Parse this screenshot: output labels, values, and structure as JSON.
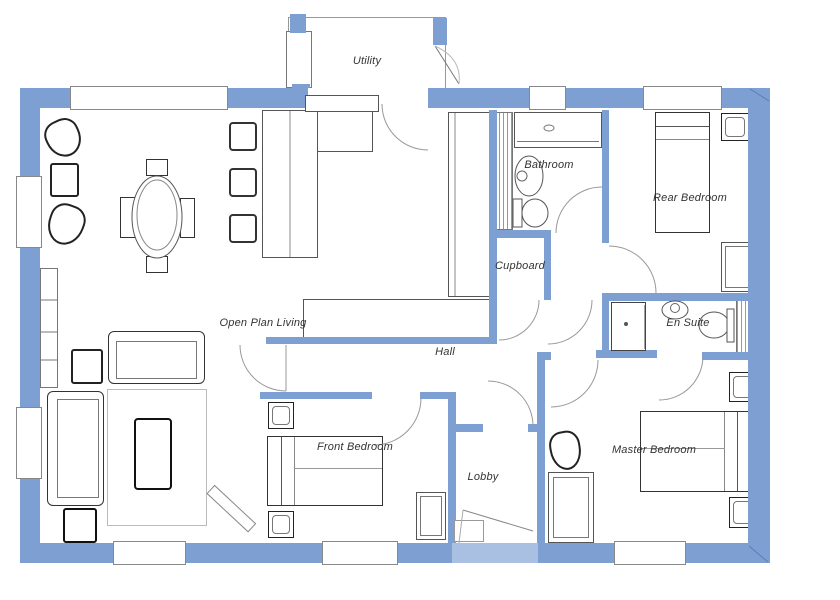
{
  "floorplan": {
    "rooms": {
      "utility": {
        "label": "Utility"
      },
      "bathroom": {
        "label": "Bathroom"
      },
      "rear_bedroom": {
        "label": "Rear Bedroom"
      },
      "cupboard": {
        "label": "Cupboard"
      },
      "open_plan_living": {
        "label": "Open Plan Living"
      },
      "en_suite": {
        "label": "En Suite"
      },
      "hall": {
        "label": "Hall"
      },
      "front_bedroom": {
        "label": "Front Bedroom"
      },
      "master_bedroom": {
        "label": "Master Bedroom"
      },
      "lobby": {
        "label": "Lobby"
      }
    },
    "colors": {
      "wall": "#7d9fd2",
      "wall_light": "#a9c0e2",
      "line": "#555555",
      "background": "#ffffff"
    }
  }
}
